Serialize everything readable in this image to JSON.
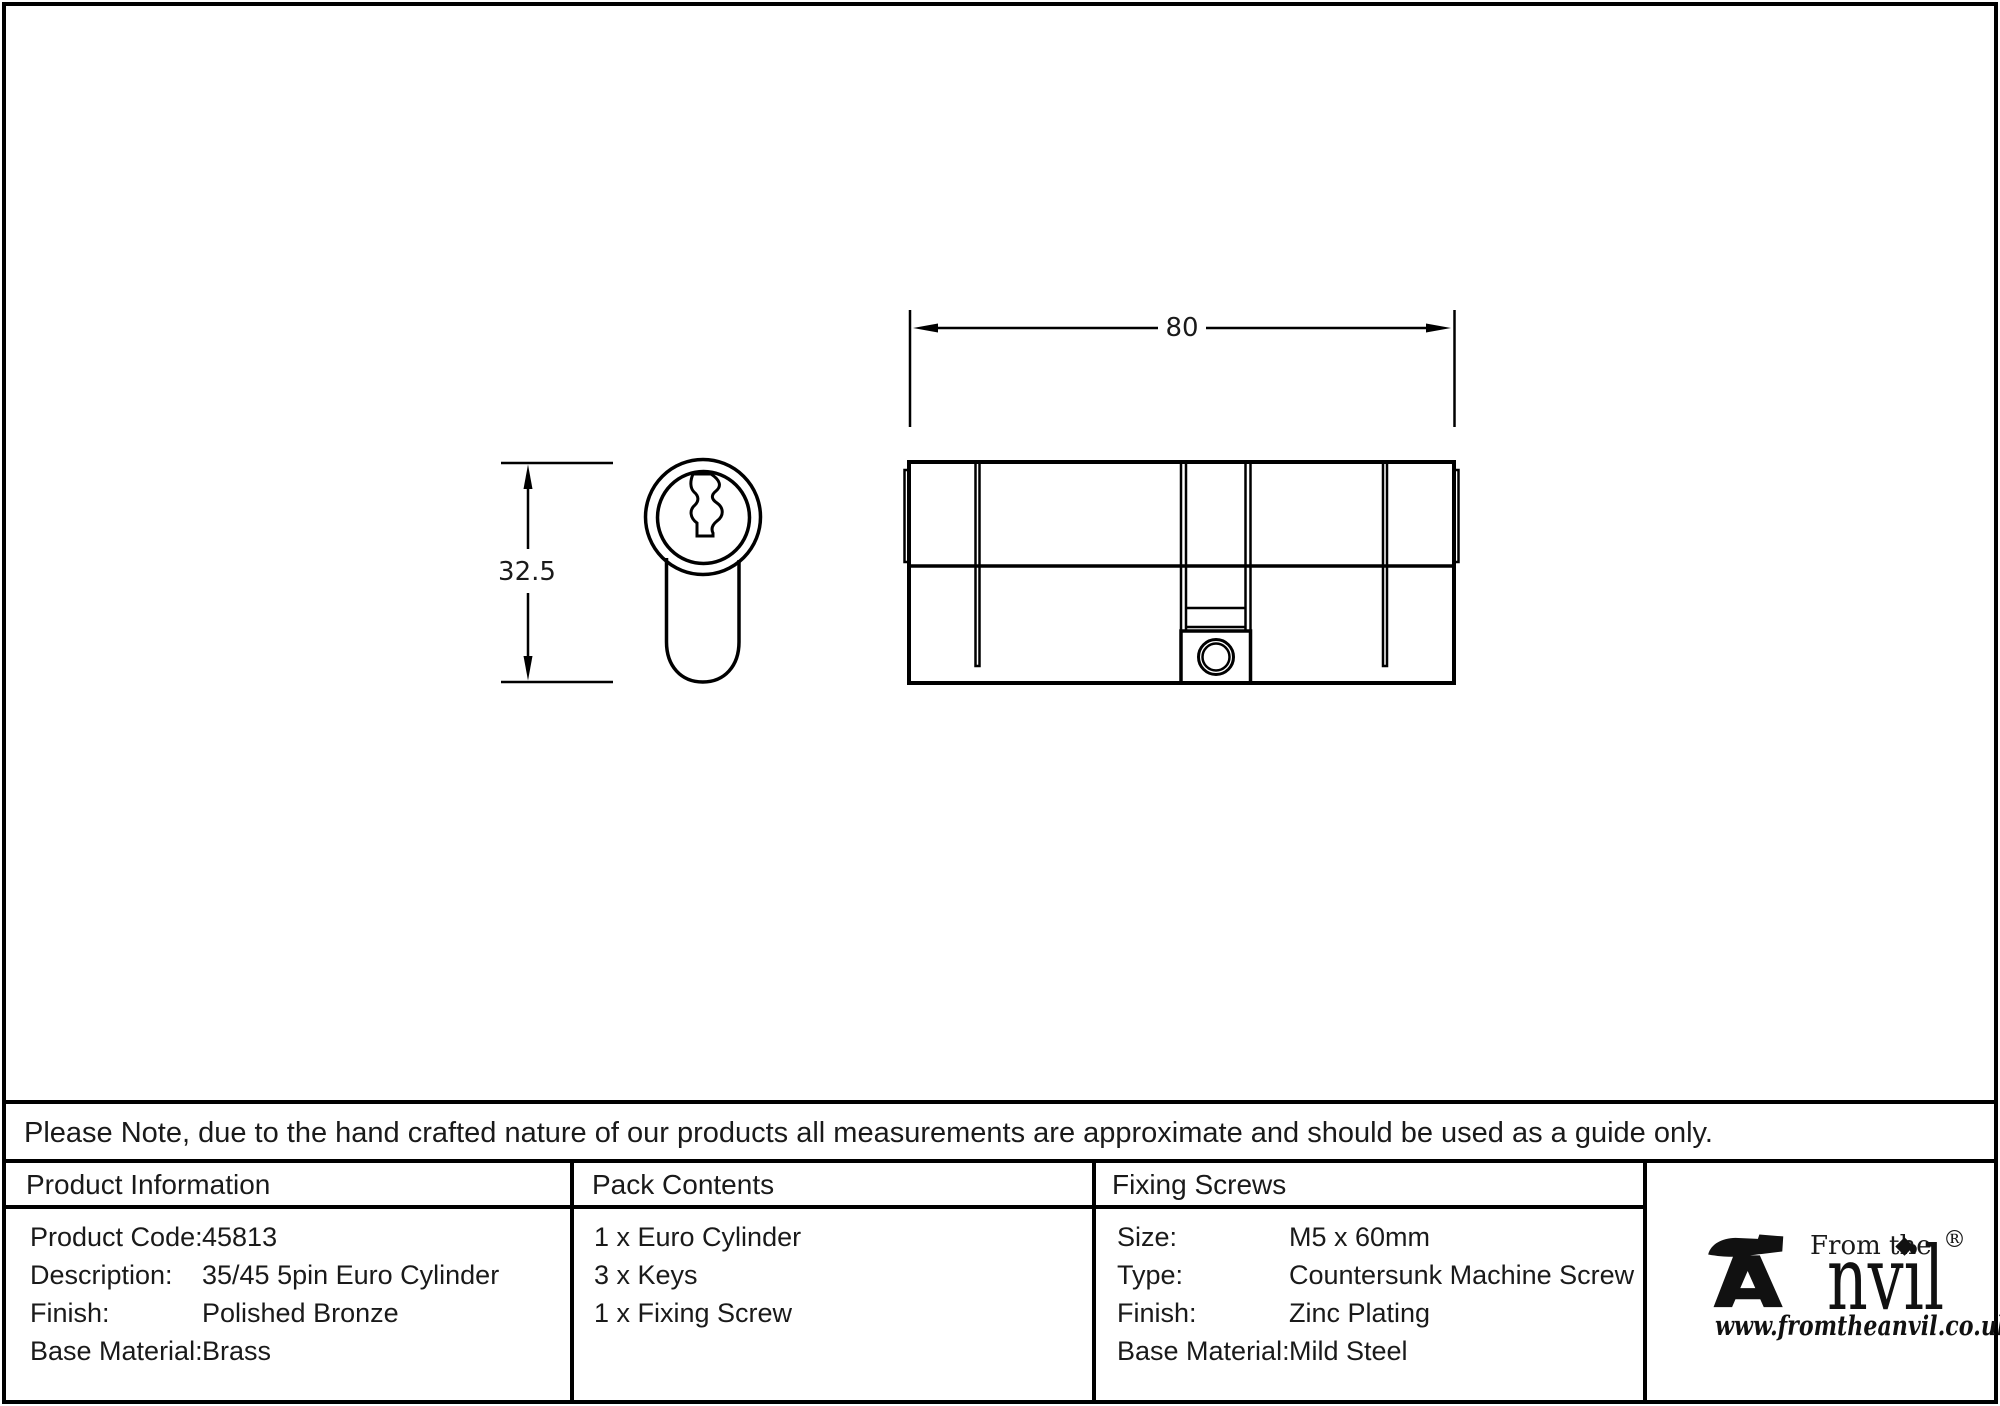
{
  "colors": {
    "ink": "#000000",
    "background": "#ffffff"
  },
  "drawing": {
    "width_mm": "80",
    "height_mm": "32.5"
  },
  "note": "Please Note, due to the hand crafted nature of our products all measurements are approximate and should be used as a guide only.",
  "product_information": {
    "header": "Product Information",
    "rows": [
      {
        "label": "Product Code:",
        "value": "45813"
      },
      {
        "label": "Description:",
        "value": "35/45 5pin Euro Cylinder"
      },
      {
        "label": "Finish:",
        "value": "Polished Bronze"
      },
      {
        "label": "Base Material:",
        "value": "Brass"
      }
    ]
  },
  "pack_contents": {
    "header": "Pack Contents",
    "items": [
      "1 x Euro Cylinder",
      "3 x Keys",
      "1 x Fixing Screw"
    ]
  },
  "fixing_screws": {
    "header": "Fixing Screws",
    "rows": [
      {
        "label": "Size:",
        "value": "M5 x 60mm"
      },
      {
        "label": "Type:",
        "value": "Countersunk Machine Screw"
      },
      {
        "label": "Finish:",
        "value": "Zinc Plating"
      },
      {
        "label": "Base Material:",
        "value": "Mild Steel"
      }
    ]
  },
  "logo": {
    "from_the": "From the",
    "brand_text": "nvil",
    "registered": "®",
    "url": "www.fromtheanvil.co.uk"
  }
}
